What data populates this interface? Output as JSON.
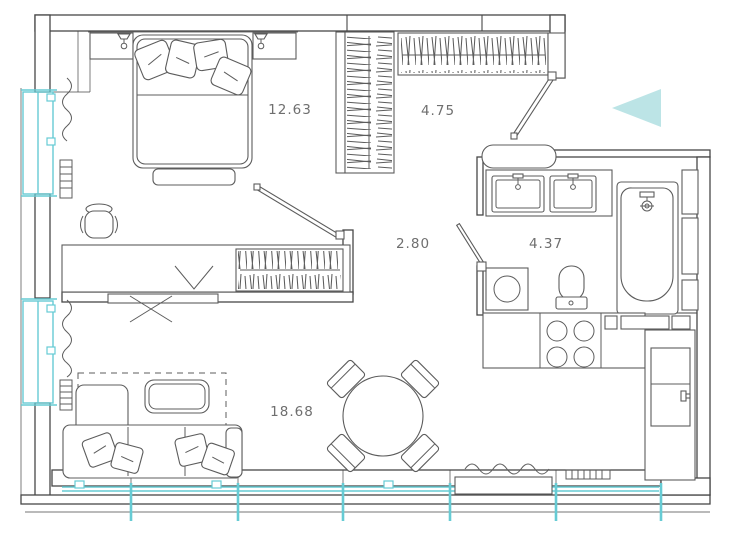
{
  "plan": {
    "type": "apartment-floor-plan",
    "rooms": [
      {
        "name": "bedroom",
        "area_label": "12.63"
      },
      {
        "name": "hallway-wardrobe",
        "area_label": "4.75"
      },
      {
        "name": "corridor",
        "area_label": "2.80"
      },
      {
        "name": "bathroom",
        "area_label": "4.37"
      },
      {
        "name": "living-room",
        "area_label": "18.68"
      }
    ],
    "icons": {
      "entry_arrow": "entry-direction-arrow-left",
      "windows": "window-glazing-cyan",
      "wardrobes": "hanging-clothes-hatching"
    },
    "colors": {
      "wall_line": "#474747",
      "furniture_line": "#5c5c5c",
      "window_accent": "#66cbd4",
      "entry_arrow_fill": "#bce4e6",
      "label_text": "#6f6f6f",
      "background": "#ffffff"
    }
  }
}
